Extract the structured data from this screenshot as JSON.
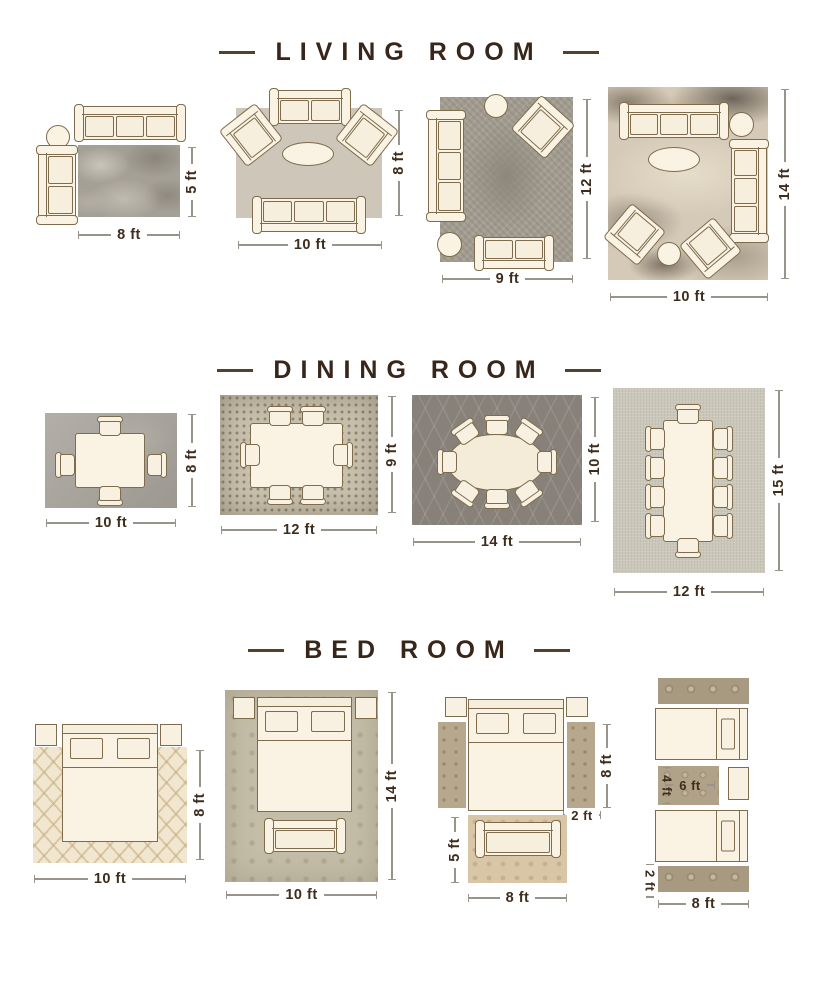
{
  "colors": {
    "background": "#ffffff",
    "title_text": "#38261a",
    "dimension_text": "#3e2d1d",
    "dimension_line": "#98948b",
    "furniture_fill": "#faf3e3",
    "furniture_outline": "#7e6c4d"
  },
  "sections": [
    {
      "title": "LIVING ROOM",
      "diagrams": [
        {
          "width": "8 ft",
          "height": "5 ft"
        },
        {
          "width": "10 ft",
          "height": "8 ft"
        },
        {
          "width": "9 ft",
          "height": "12 ft"
        },
        {
          "width": "10 ft",
          "height": "14 ft"
        }
      ]
    },
    {
      "title": "DINING ROOM",
      "diagrams": [
        {
          "width": "10 ft",
          "height": "8 ft"
        },
        {
          "width": "12 ft",
          "height": "9 ft"
        },
        {
          "width": "14 ft",
          "height": "10 ft"
        },
        {
          "width": "12 ft",
          "height": "15 ft"
        }
      ]
    },
    {
      "title": "BED ROOM",
      "diagrams": [
        {
          "width": "10 ft",
          "height": "8 ft"
        },
        {
          "width": "10 ft",
          "height": "14 ft"
        },
        {
          "runner_length": "8 ft",
          "runner_width": "2 ft",
          "foot_rug_height": "5 ft",
          "foot_rug_width": "8 ft"
        },
        {
          "center_rug_height": "4 ft",
          "center_rug_width": "6 ft",
          "runner_width": "2 ft",
          "runner_length": "8 ft"
        }
      ]
    }
  ]
}
